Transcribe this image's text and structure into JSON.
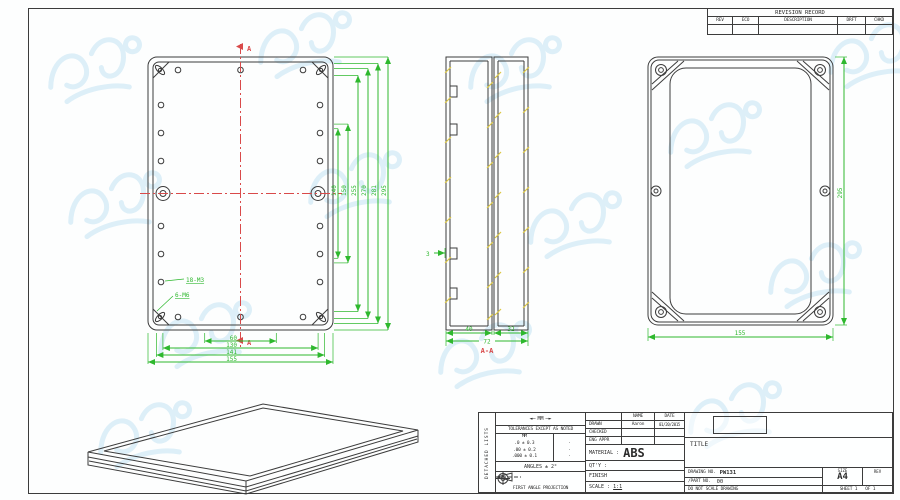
{
  "revision_table": {
    "title": "REVISION RECORD",
    "columns": [
      "REV",
      "ECO",
      "DESCRIPTION",
      "DRFT",
      "CHKD"
    ]
  },
  "back_view": {
    "section_label_top": "A",
    "section_label_bottom": "A",
    "note_m3": "18-M3",
    "note_m6": "6-M6",
    "dims_right": [
      "140",
      "150",
      "255",
      "270",
      "281",
      "295"
    ],
    "dims_bottom": [
      "60",
      "130",
      "141",
      "155"
    ]
  },
  "section_view": {
    "label": "A-A",
    "dim_left": "40",
    "dim_right": "32",
    "dim_total": "72",
    "dim_wall": "3"
  },
  "front_view": {
    "dim_width": "155",
    "dim_height": "295"
  },
  "title_block": {
    "side_label": "DETACHED LISTS",
    "units_label": "MM",
    "tolerance_note": "TOLERANCES EXCEPT AS NOTED",
    "tol_header": "MM",
    "tolerances": [
      {
        "mm": ".0 ± 0.3",
        "in": "·"
      },
      {
        "mm": ".00 ± 0.2",
        "in": "·"
      },
      {
        "mm": ".000 ± 0.1",
        "in": "·"
      }
    ],
    "angles_note": "ANGLES ± 2°",
    "projection_note": "FIRST ANGLE PROJECTION",
    "name_header": "NAME",
    "date_header": "DATE",
    "drawn_label": "DRAWN",
    "drawn_name": "Aaron",
    "drawn_date": "01/20/2015",
    "checked_label": "CHECKED",
    "eng_appr_label": "ENG APPR",
    "material_label": "MATERIAL :",
    "material_value": "ABS",
    "qty_label": "QT'Y :",
    "finish_label": "FINISH",
    "scale_label": "SCALE :",
    "scale_value": "1:1",
    "title_label": "TITLE",
    "drawing_no_label": "DRAWING NO.",
    "drawing_no_value": "PW131",
    "part_no_label": "/PART NO.",
    "part_no_value": "00",
    "size_label": "SIZE",
    "size_value": "A4",
    "rev_label": "REV",
    "do_not_scale": "DO NOT SCALE DRAWING",
    "sheet_text": "SHEET 1",
    "of_text": "OF 1"
  }
}
